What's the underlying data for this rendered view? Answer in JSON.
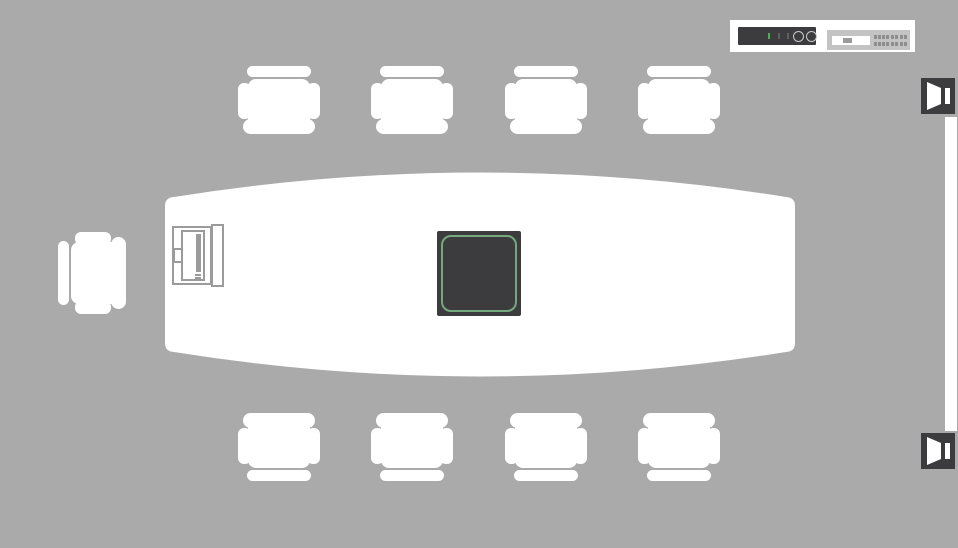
{
  "meta": {
    "view": "conference-room-floor-plan",
    "background_color": "#a9aaa9"
  },
  "palette": {
    "bg": "#a9aaa9",
    "white": "#ffffff",
    "dark": "#3c3c3e",
    "green_outline": "#74a97d",
    "led_green": "#4db056",
    "tick_gray": "#5f5f61",
    "ring_gray": "#c9c9c9",
    "outline_gray": "#9b9b9b",
    "switch_gray": "#c3c3c3",
    "port_gray": "#8e8e8e"
  },
  "table": {
    "name": "conference-table",
    "shape": "boat",
    "color": "#ffffff"
  },
  "chairs": {
    "count": 9,
    "items": [
      {
        "x": 238,
        "y": 64,
        "facing": "down"
      },
      {
        "x": 371,
        "y": 64,
        "facing": "down"
      },
      {
        "x": 505,
        "y": 64,
        "facing": "down"
      },
      {
        "x": 638,
        "y": 64,
        "facing": "down"
      },
      {
        "x": 238,
        "y": 413,
        "facing": "up"
      },
      {
        "x": 371,
        "y": 413,
        "facing": "up"
      },
      {
        "x": 505,
        "y": 413,
        "facing": "up"
      },
      {
        "x": 638,
        "y": 413,
        "facing": "up"
      },
      {
        "x": 50,
        "y": 238,
        "facing": "right"
      }
    ]
  },
  "table_devices": {
    "hub": {
      "name": "table-hub-device",
      "body_color": "#3c3c3e",
      "screen_outline": "#74a97d"
    },
    "cubby": {
      "name": "connection-panel",
      "outline_color": "#9b9b9b"
    }
  },
  "rack": {
    "amp": {
      "name": "amplifier-device",
      "leds": [
        "green",
        "gray",
        "gray"
      ],
      "knobs": 2
    },
    "switch": {
      "name": "network-switch-device",
      "port_rows": 2,
      "port_groups": [
        4,
        2,
        2
      ]
    }
  },
  "speakers": {
    "icon": "speaker-icon",
    "count": 2,
    "items": [
      {
        "x": 921,
        "y": 78
      },
      {
        "x": 921,
        "y": 433
      }
    ]
  },
  "display": {
    "name": "wall-display",
    "color": "#ffffff"
  }
}
